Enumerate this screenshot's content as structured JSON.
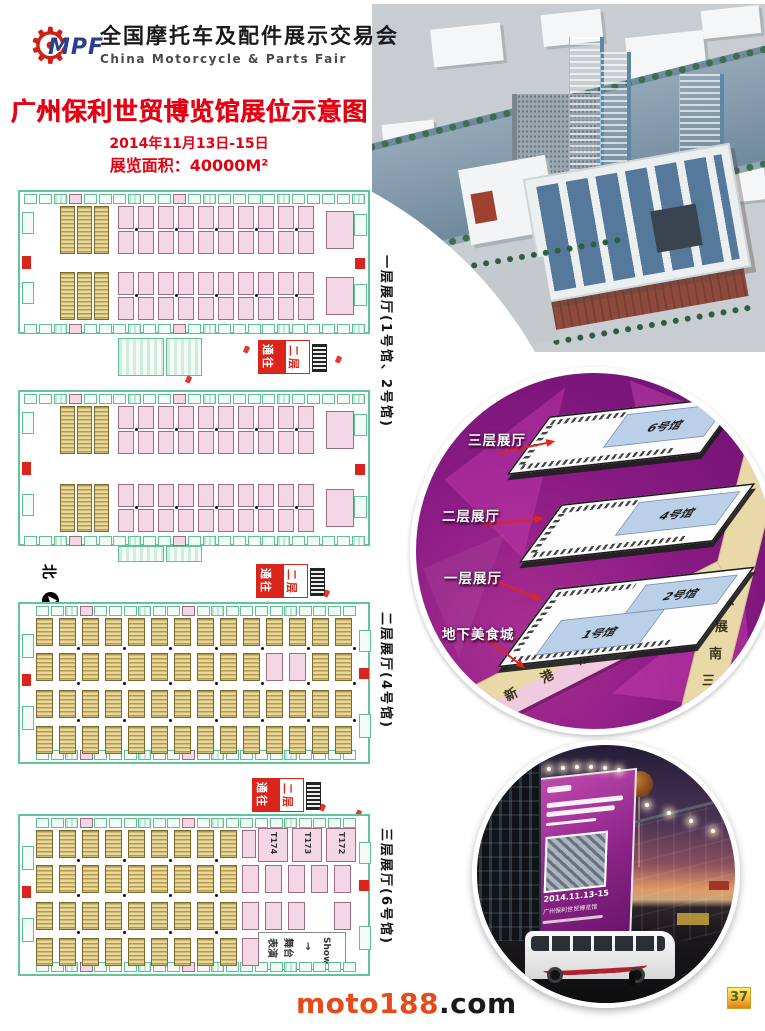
{
  "header": {
    "logo_text": "MPF",
    "org_cn": "全国摩托车及配件展示交易会",
    "org_en": "China Motorcycle & Parts Fair"
  },
  "title_block": {
    "main_title": "广州保利世贸博览馆展位示意图",
    "date_line": "2014年11月13日-15日",
    "area_line": "展览面积：40000M²"
  },
  "floor_plans": [
    {
      "side_label": "一层展厅(1号馆、2号馆)",
      "sign_left": "通往",
      "sign_right": "二层"
    },
    {
      "side_label": "二层展厅(4号馆)",
      "compass": "北",
      "sign_left": "通往",
      "sign_right": "二层"
    },
    {
      "side_label": "三层展厅(6号馆)",
      "sign_left": "通往",
      "sign_right": "二层",
      "booth_labels": [
        "T174",
        "T173",
        "T172"
      ],
      "show_area_col1": "表演",
      "show_area_col2": "舞台",
      "show_area_arrow": "→",
      "show_area_en": "Show"
    }
  ],
  "stack_diagram": {
    "labels": {
      "f3": "三层展厅",
      "f2": "二层展厅",
      "f1": "一层展厅",
      "b1": "地下美食城"
    },
    "halls": {
      "h6": "6号馆",
      "h4": "4号馆",
      "h2": "2号馆",
      "h1": "1号馆"
    },
    "roads": {
      "south": "新港东路",
      "east": "会展南三路"
    }
  },
  "night_photo": {
    "billboard_date": "2014.11.13-15",
    "billboard_venue": "广州保利世贸博览馆"
  },
  "footer": {
    "site_name": "moto188",
    "site_tld": ".com",
    "page_number": "37"
  },
  "colors": {
    "accent_red": "#d9251c",
    "title_red": "#e50012",
    "booth_pink": "#f3d7e4",
    "wall_green": "#62c49a",
    "booth_tan": "#e8d89c",
    "circle_purple": "#8a1b84",
    "road_tan": "#ead9a8",
    "site_orange": "#e64a19",
    "badge_gold": "#f3a52c"
  }
}
